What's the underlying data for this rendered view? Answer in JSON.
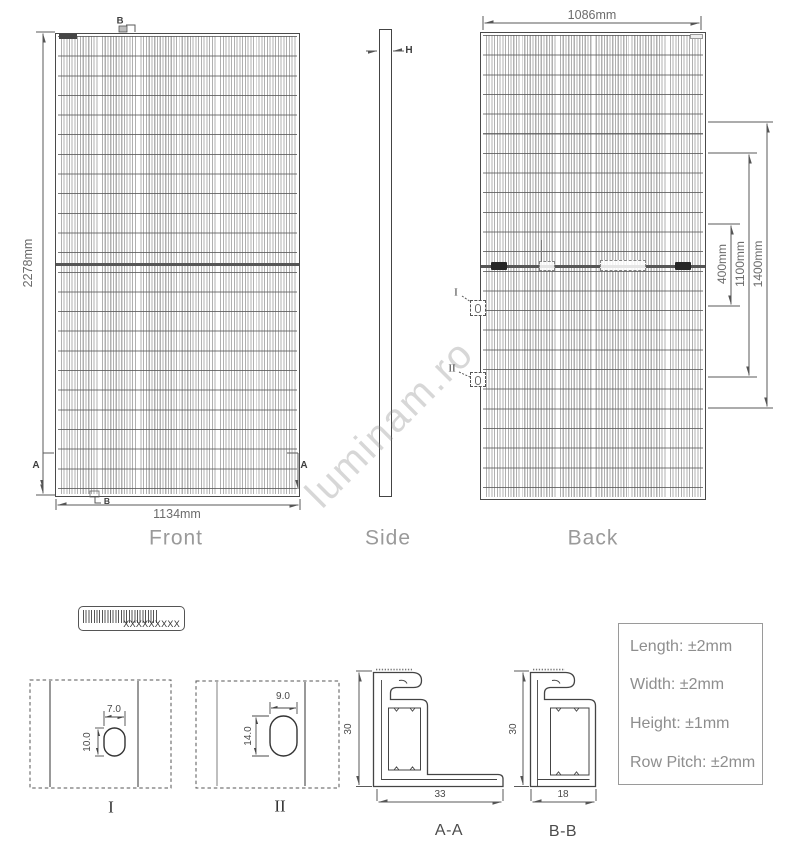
{
  "watermark": "luminam.ro",
  "views": {
    "front": {
      "label": "Front",
      "height_dim": "2278mm",
      "width_dim": "1134mm",
      "section_b": "B",
      "section_a": "A"
    },
    "side": {
      "label": "Side",
      "height_marker": "H"
    },
    "back": {
      "label": "Back",
      "width_dim": "1086mm",
      "mount_dim_inner": "400mm",
      "mount_dim_mid": "1100mm",
      "mount_dim_outer": "1400mm",
      "detail_i": "I",
      "detail_ii": "II"
    }
  },
  "serial_label": {
    "text": "XXXXXXXXX"
  },
  "details": {
    "i": {
      "label": "I",
      "slot_width": "7.0",
      "slot_height": "10.0"
    },
    "ii": {
      "label": "II",
      "slot_width": "9.0",
      "slot_height": "14.0"
    }
  },
  "sections": {
    "aa": {
      "label": "A-A",
      "height_dim": "30",
      "width_dim": "33"
    },
    "bb": {
      "label": "B-B",
      "height_dim": "30",
      "width_dim": "18"
    }
  },
  "tolerances": {
    "length": "Length: ±2mm",
    "width": "Width: ±2mm",
    "height": "Height: ±1mm",
    "row_pitch": "Row Pitch: ±2mm"
  }
}
